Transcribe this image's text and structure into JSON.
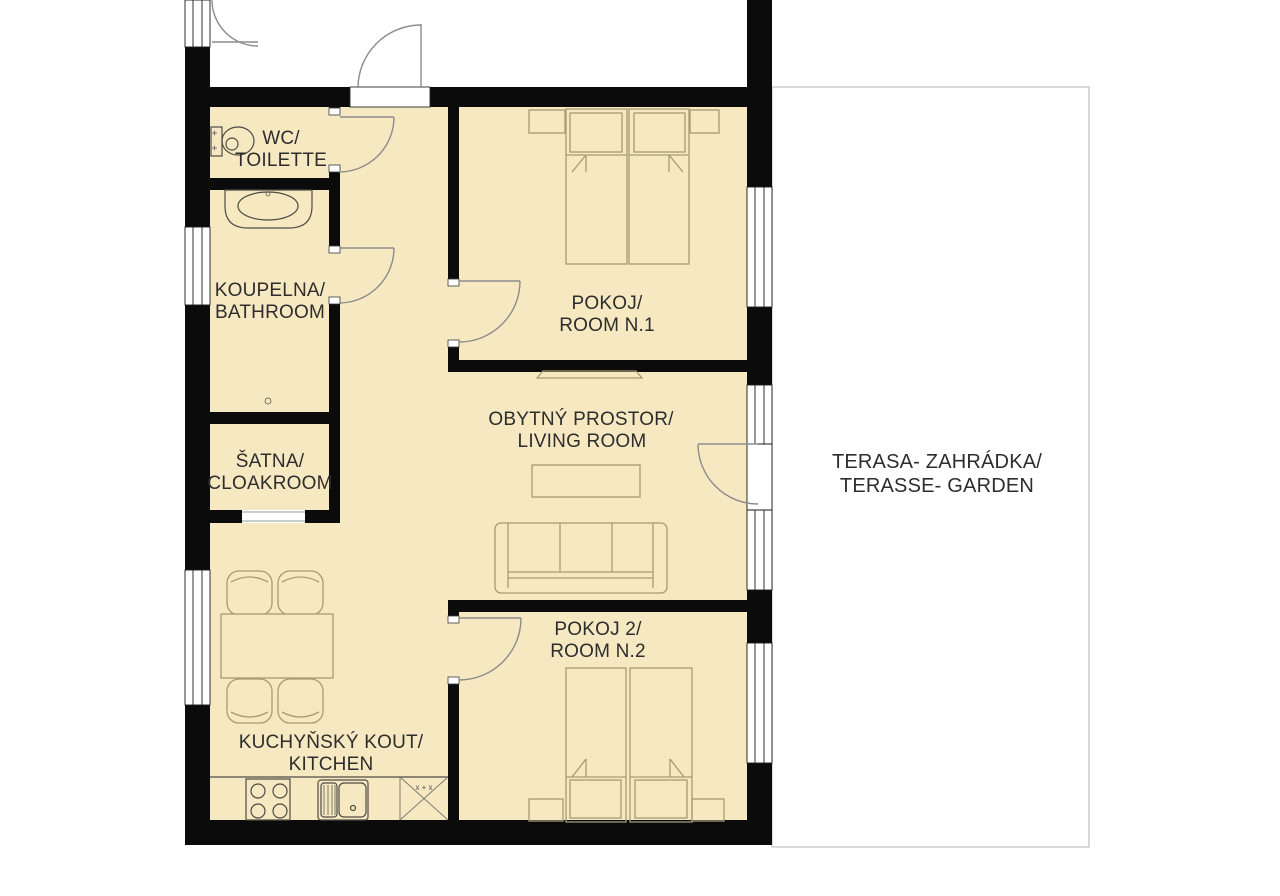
{
  "colors": {
    "wall": "#0b0b0b",
    "floor": "#f6e8c1",
    "furniture_line": "#a69c72",
    "fixture_line": "#4c4c44",
    "door_line": "#8c8c8c",
    "terrace_border": "#cbcbcb",
    "text": "#2d2d2d",
    "background": "#ffffff"
  },
  "rooms": [
    {
      "id": "wc-toilette",
      "lines": [
        "WC/",
        "TOILETTE"
      ]
    },
    {
      "id": "bathroom",
      "lines": [
        "KOUPELNA/",
        "BATHROOM"
      ]
    },
    {
      "id": "cloakroom",
      "lines": [
        "ŠATNA/",
        "CLOAKROOM"
      ]
    },
    {
      "id": "room1",
      "lines": [
        "POKOJ/",
        "ROOM N.1"
      ]
    },
    {
      "id": "living-room",
      "lines": [
        "OBYTNÝ PROSTOR/",
        "LIVING ROOM"
      ]
    },
    {
      "id": "room2",
      "lines": [
        "POKOJ 2/",
        "ROOM N.2"
      ]
    },
    {
      "id": "kitchen",
      "lines": [
        "KUCHYŇSKÝ KOUT/",
        "KITCHEN"
      ]
    },
    {
      "id": "terrace",
      "lines": [
        "TERASA- ZAHRÁDKA/",
        "TERASSE- GARDEN"
      ]
    }
  ],
  "kitchen_unit_marks": "x + x"
}
